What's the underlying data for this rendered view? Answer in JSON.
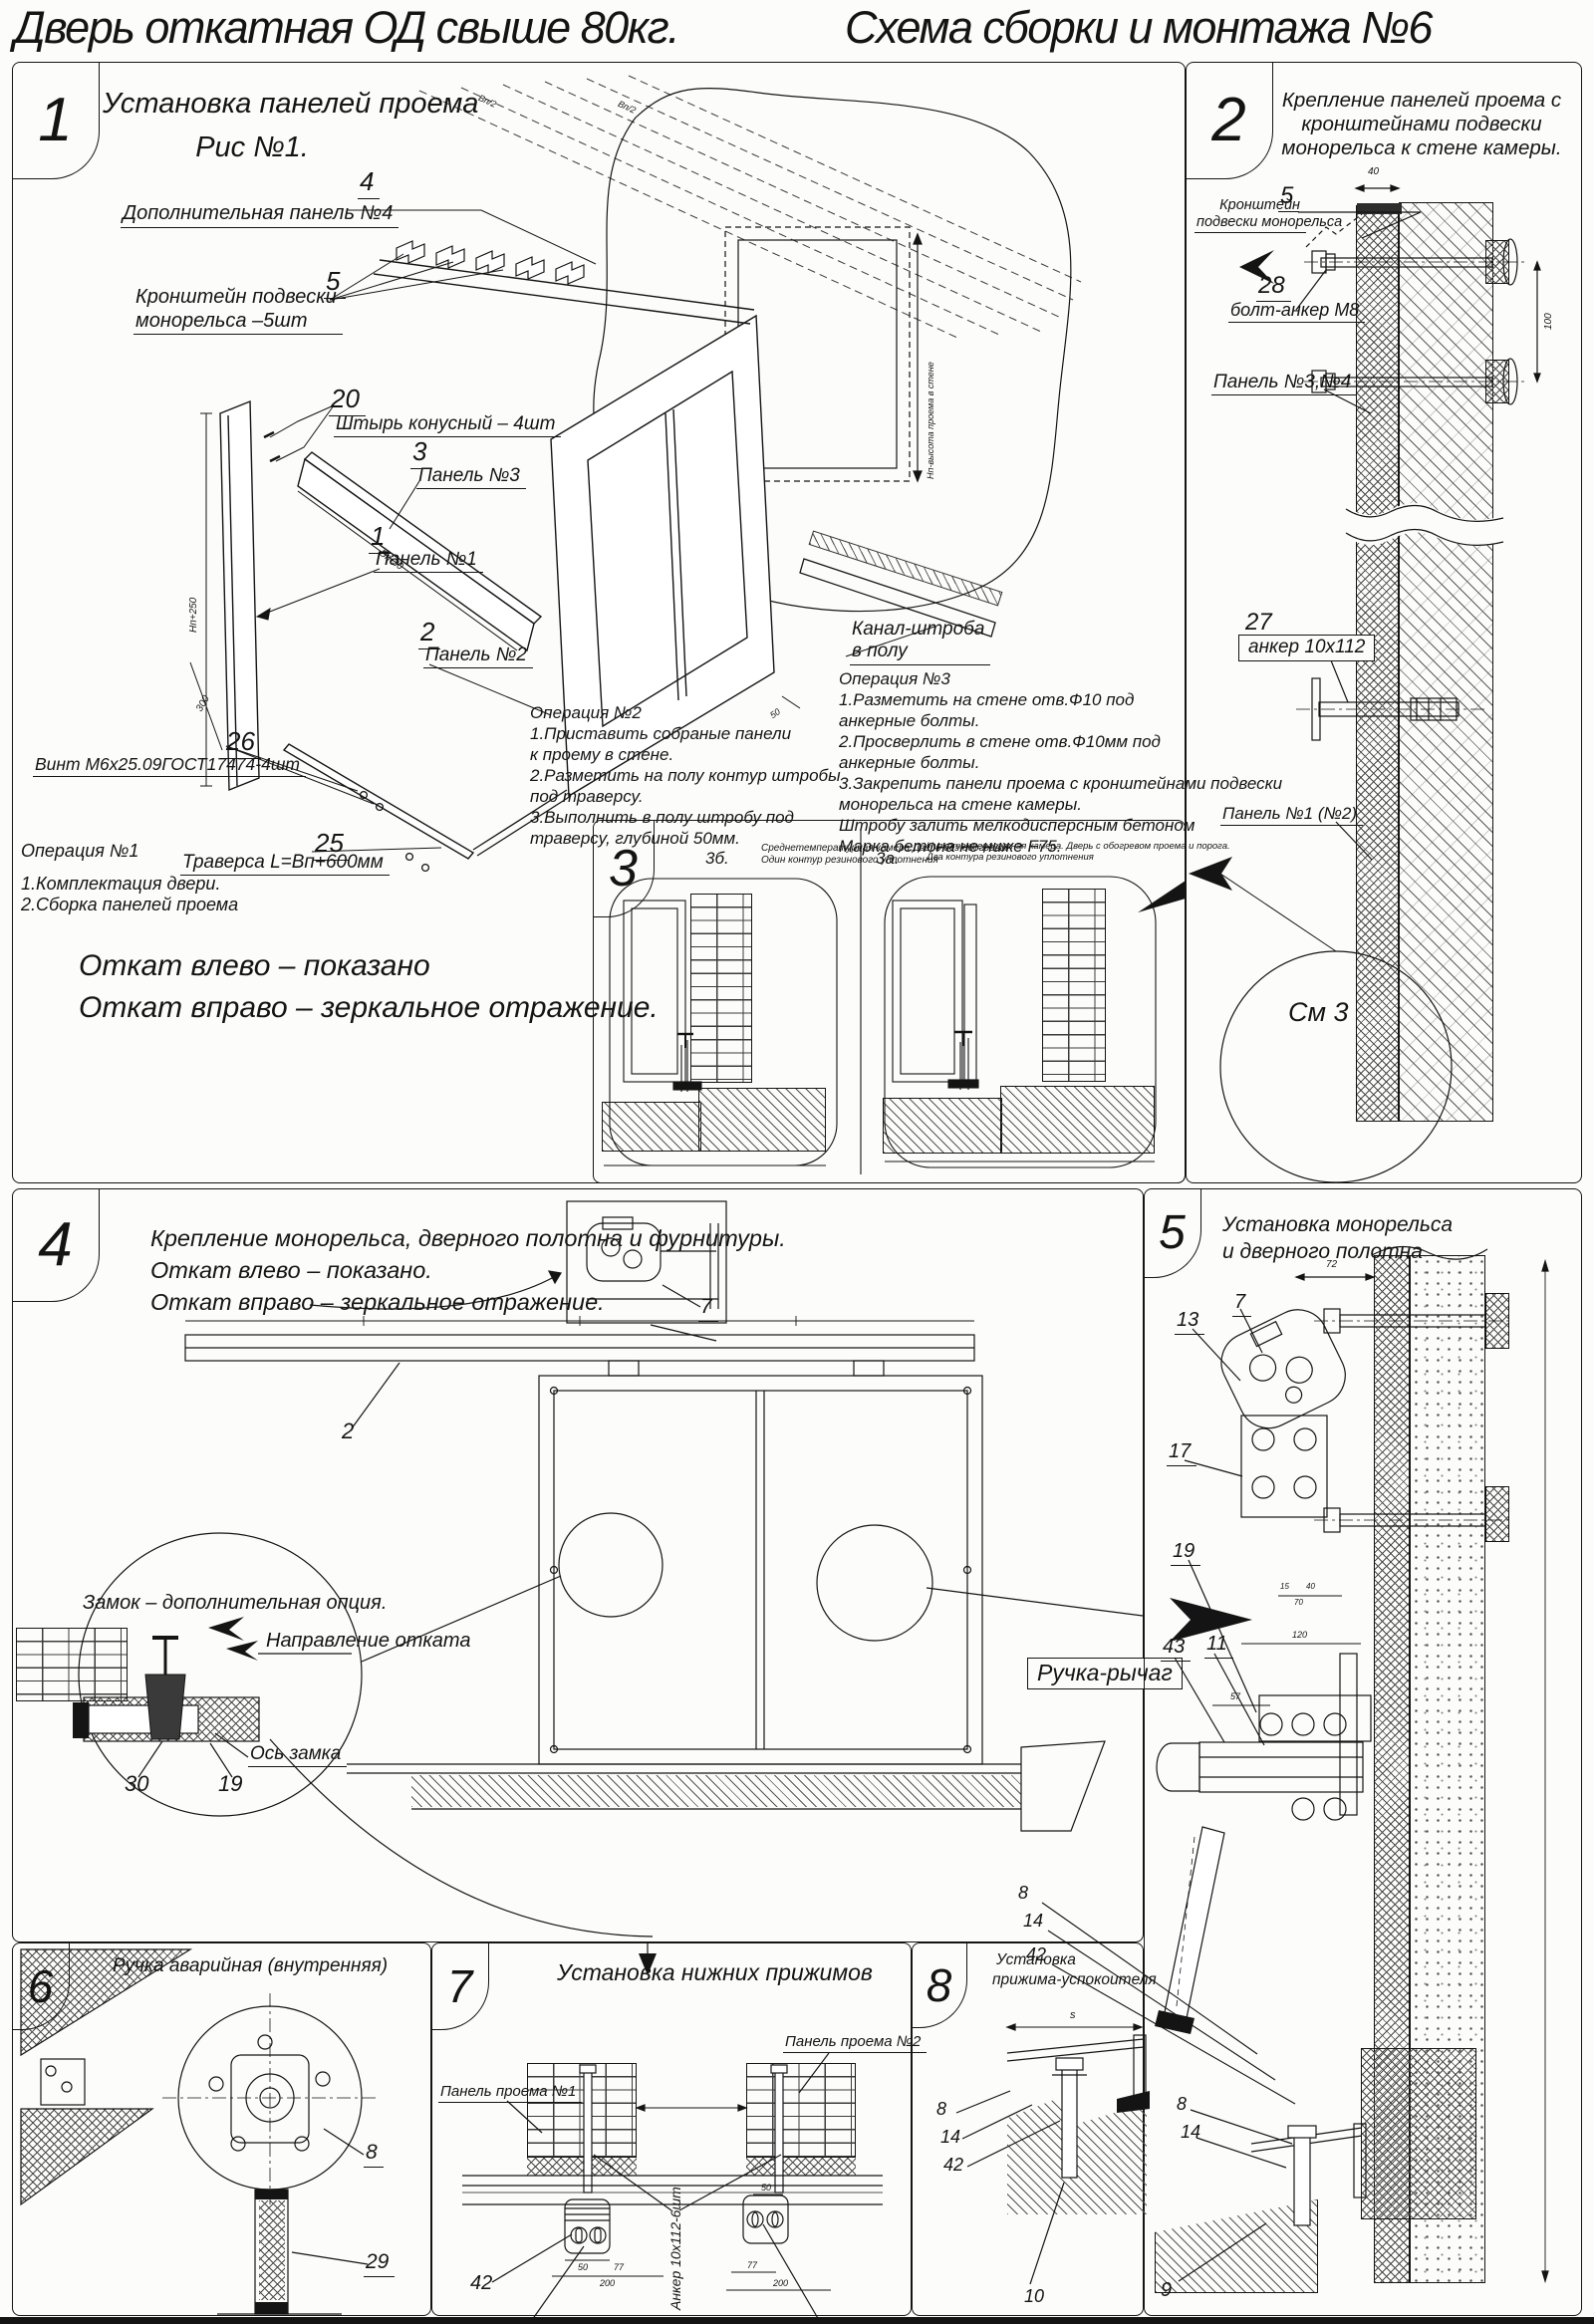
{
  "title": {
    "left": "Дверь откатная ОД свыше 80кг.",
    "right": "Схема сборки и монтажа №6"
  },
  "p1": {
    "num": "1",
    "heading": "Установка панелей проема",
    "fig": "Рис №1.",
    "c4n": "4",
    "c4": "Дополнительная панель №4",
    "c5n": "5",
    "c5l1": "Кронштейн подвески",
    "c5l2": "монорельса –5шт",
    "c20n": "20",
    "c20": "Штырь конусный – 4шт",
    "c3n": "3",
    "c3": "Панель №3",
    "c1n": "1",
    "c1": "Панель №1",
    "c2n": "2",
    "c2": "Панель №2",
    "c26n": "26",
    "c26": "Винт М6х25.09ГОСТ17474-4шт",
    "c25n": "25",
    "c25": "Траверса  L=Вп+600мм",
    "chan1": "Канал-штроба",
    "chan2": "в полу",
    "op1": [
      "Операция №1",
      "1.Комплектация двери.",
      "2.Сборка панелей проема"
    ],
    "op2": [
      "Операция №2",
      "1.Приставить собраные панели",
      "к проему в стене.",
      "2.Разметить на полу контур штробы",
      "под траверсу.",
      "3.Выполнить в полу штробу под",
      "траверсу, глубиной 50мм."
    ],
    "op3": [
      "Операция №3",
      "1.Разметить на стене отв.Ф10 под",
      "анкерные болты.",
      "2.Просверлить в стене отв.Ф10мм   под",
      "анкерные болты.",
      "3.Закрепить панели проема с кронштейнами подвески",
      "монорельса на стене камеры.",
      "Штробу залить мелкодисперсным бетоном",
      "Марка бетона не ниже   F75."
    ],
    "note1": "Откат влево – показано",
    "note2": "Откат вправо – зеркальное отражение.",
    "dim_h": "Нп+250",
    "dim_w": "Вп-30",
    "dim300": "300",
    "dim50": "50",
    "dim_hw": "Нп-высота проема в стене",
    "dim_vp2": "Вп/2"
  },
  "p2": {
    "num": "2",
    "h1": "Крепление панелей проема с",
    "h2": "кронштейнами  подвески",
    "h3": "монорельса к стене камеры.",
    "c5n": "5",
    "c5l1": "Кронштейн",
    "c5l2": "подвески монорельса",
    "c28n": "28",
    "c28": "болт-анкер М8",
    "p34": "Панель №3,№4",
    "c27n": "27",
    "c27": "анкер 10х112",
    "p12": "Панель №1 (№2)",
    "see": "См 3",
    "d40": "40",
    "d100": "100"
  },
  "p3": {
    "num": "3",
    "bn": "3б.",
    "b1": "Среднетемпературная камера.Дверь без обогрева",
    "b2": "Один контур резинового уплотнения",
    "an": "3а.",
    "a1": "Низкотемпературная камера. Дверь с обогревом проема и порога.",
    "a2": "Два контура резинового уплотнения"
  },
  "p4": {
    "num": "4",
    "h1": "Крепление монорельса, дверного полотна и фурнитуры.",
    "h2": "Откат влево – показано.",
    "h3": "Откат вправо – зеркальное отражение.",
    "c7": "7",
    "c2": "2",
    "lock": "Замок – дополнительная опция.",
    "dir": "Направление отката",
    "axis": "Ось замка",
    "c30": "30",
    "c19": "19",
    "handle": "Ручка-рычаг"
  },
  "p5": {
    "num": "5",
    "h1": "Установка монорельса",
    "h2": "и дверного полотна",
    "c7": "7",
    "c13": "13",
    "c17": "17",
    "c19": "19",
    "c43": "43",
    "c11": "11",
    "d72": "72",
    "d15": "15",
    "d40": "40",
    "d70": "70",
    "d120": "120",
    "d57": "57",
    "c8": "8",
    "c14": "14",
    "c9": "9"
  },
  "p6": {
    "num": "6",
    "h": "Ручка аварийная (внутренняя)",
    "c8": "8",
    "c29": "29"
  },
  "p7": {
    "num": "7",
    "h": "Установка  нижних прижимов",
    "pp1": "Панель проема №1",
    "pp2": "Панель проема №2",
    "anchor": "Анкер  10х112-6шт",
    "c42": "42",
    "c10": "10",
    "c9": "9",
    "d50": "50",
    "d77": "77",
    "d200": "200"
  },
  "p8": {
    "num": "8",
    "h1": "Установка",
    "h2": "прижима-успокоителя",
    "c8": "8",
    "c14": "14",
    "c42": "42",
    "c10": "10",
    "ds": "s"
  },
  "x": {
    "c8": "8",
    "c14": "14",
    "c42": "42"
  }
}
